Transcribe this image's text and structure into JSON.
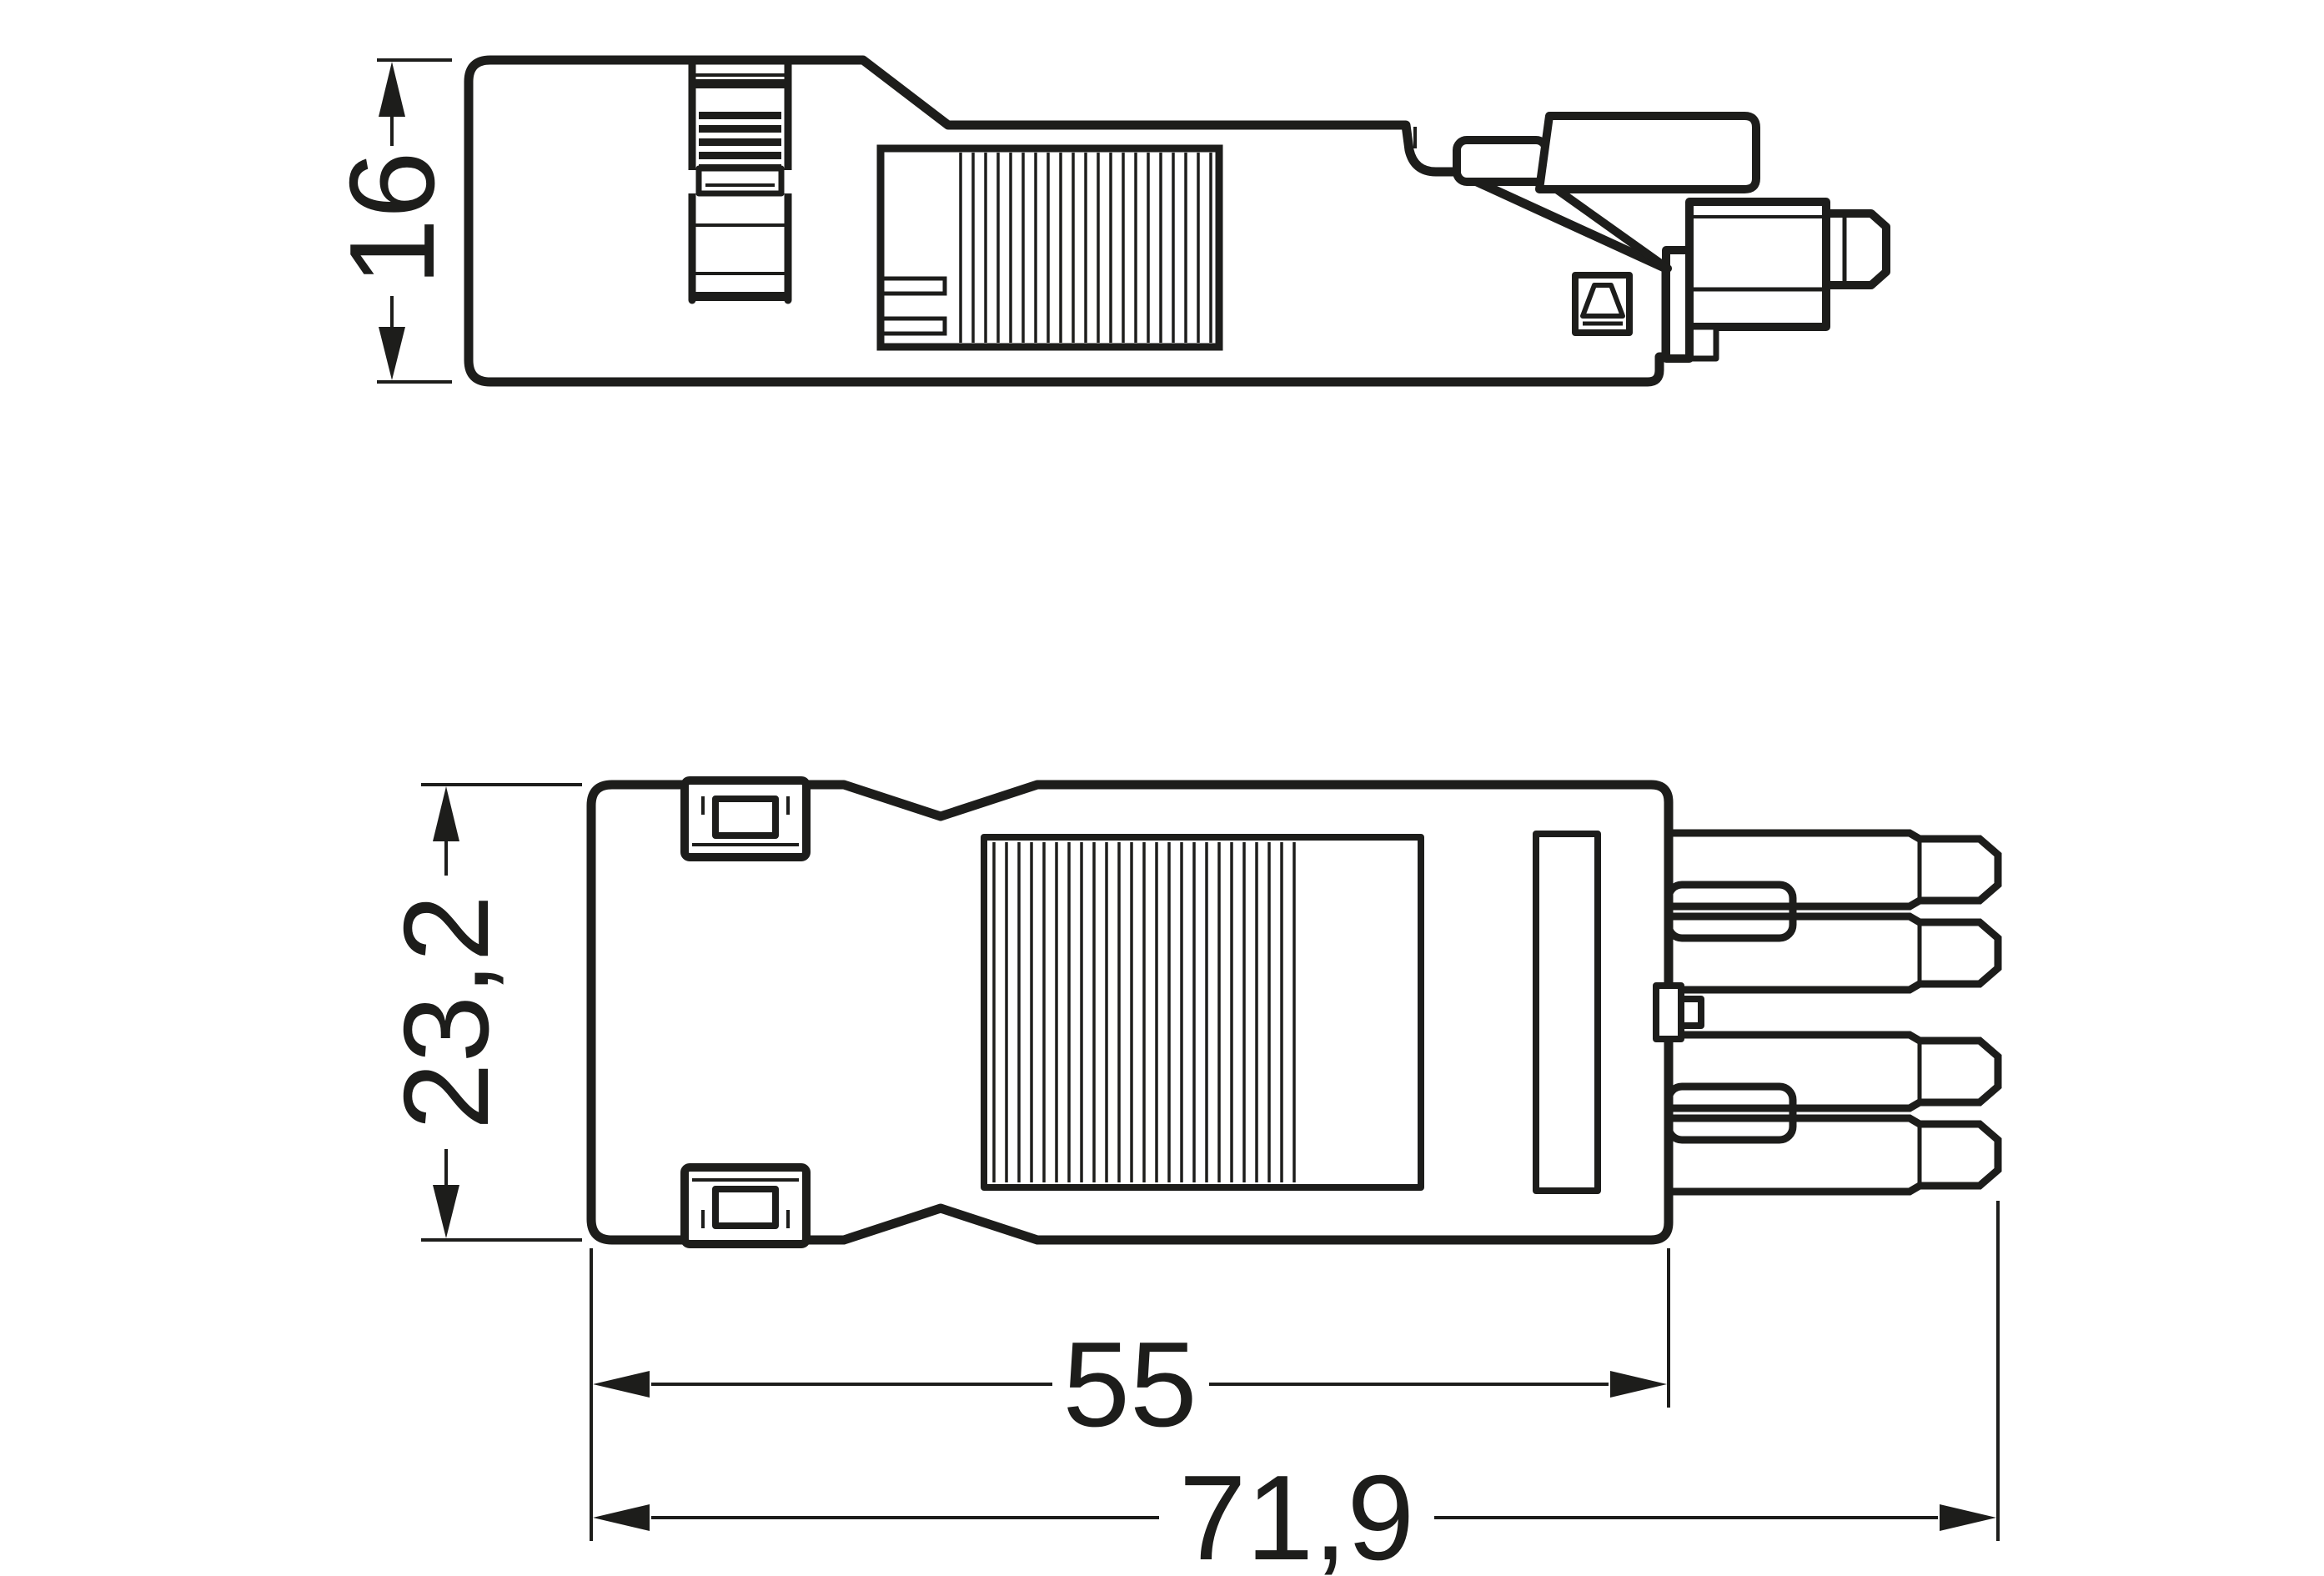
{
  "drawing": {
    "background": "#ffffff",
    "line_color": "#1d1d1b",
    "views": {
      "side": {
        "name": "side-view"
      },
      "plan": {
        "name": "plan-view"
      }
    },
    "dimensions": {
      "side_height": {
        "label": "16"
      },
      "plan_height": {
        "label": "23,2"
      },
      "body_length": {
        "label": "55"
      },
      "total_length": {
        "label": "71,9"
      }
    },
    "symbols": {
      "coding_mark": "wedge-in-box"
    }
  }
}
